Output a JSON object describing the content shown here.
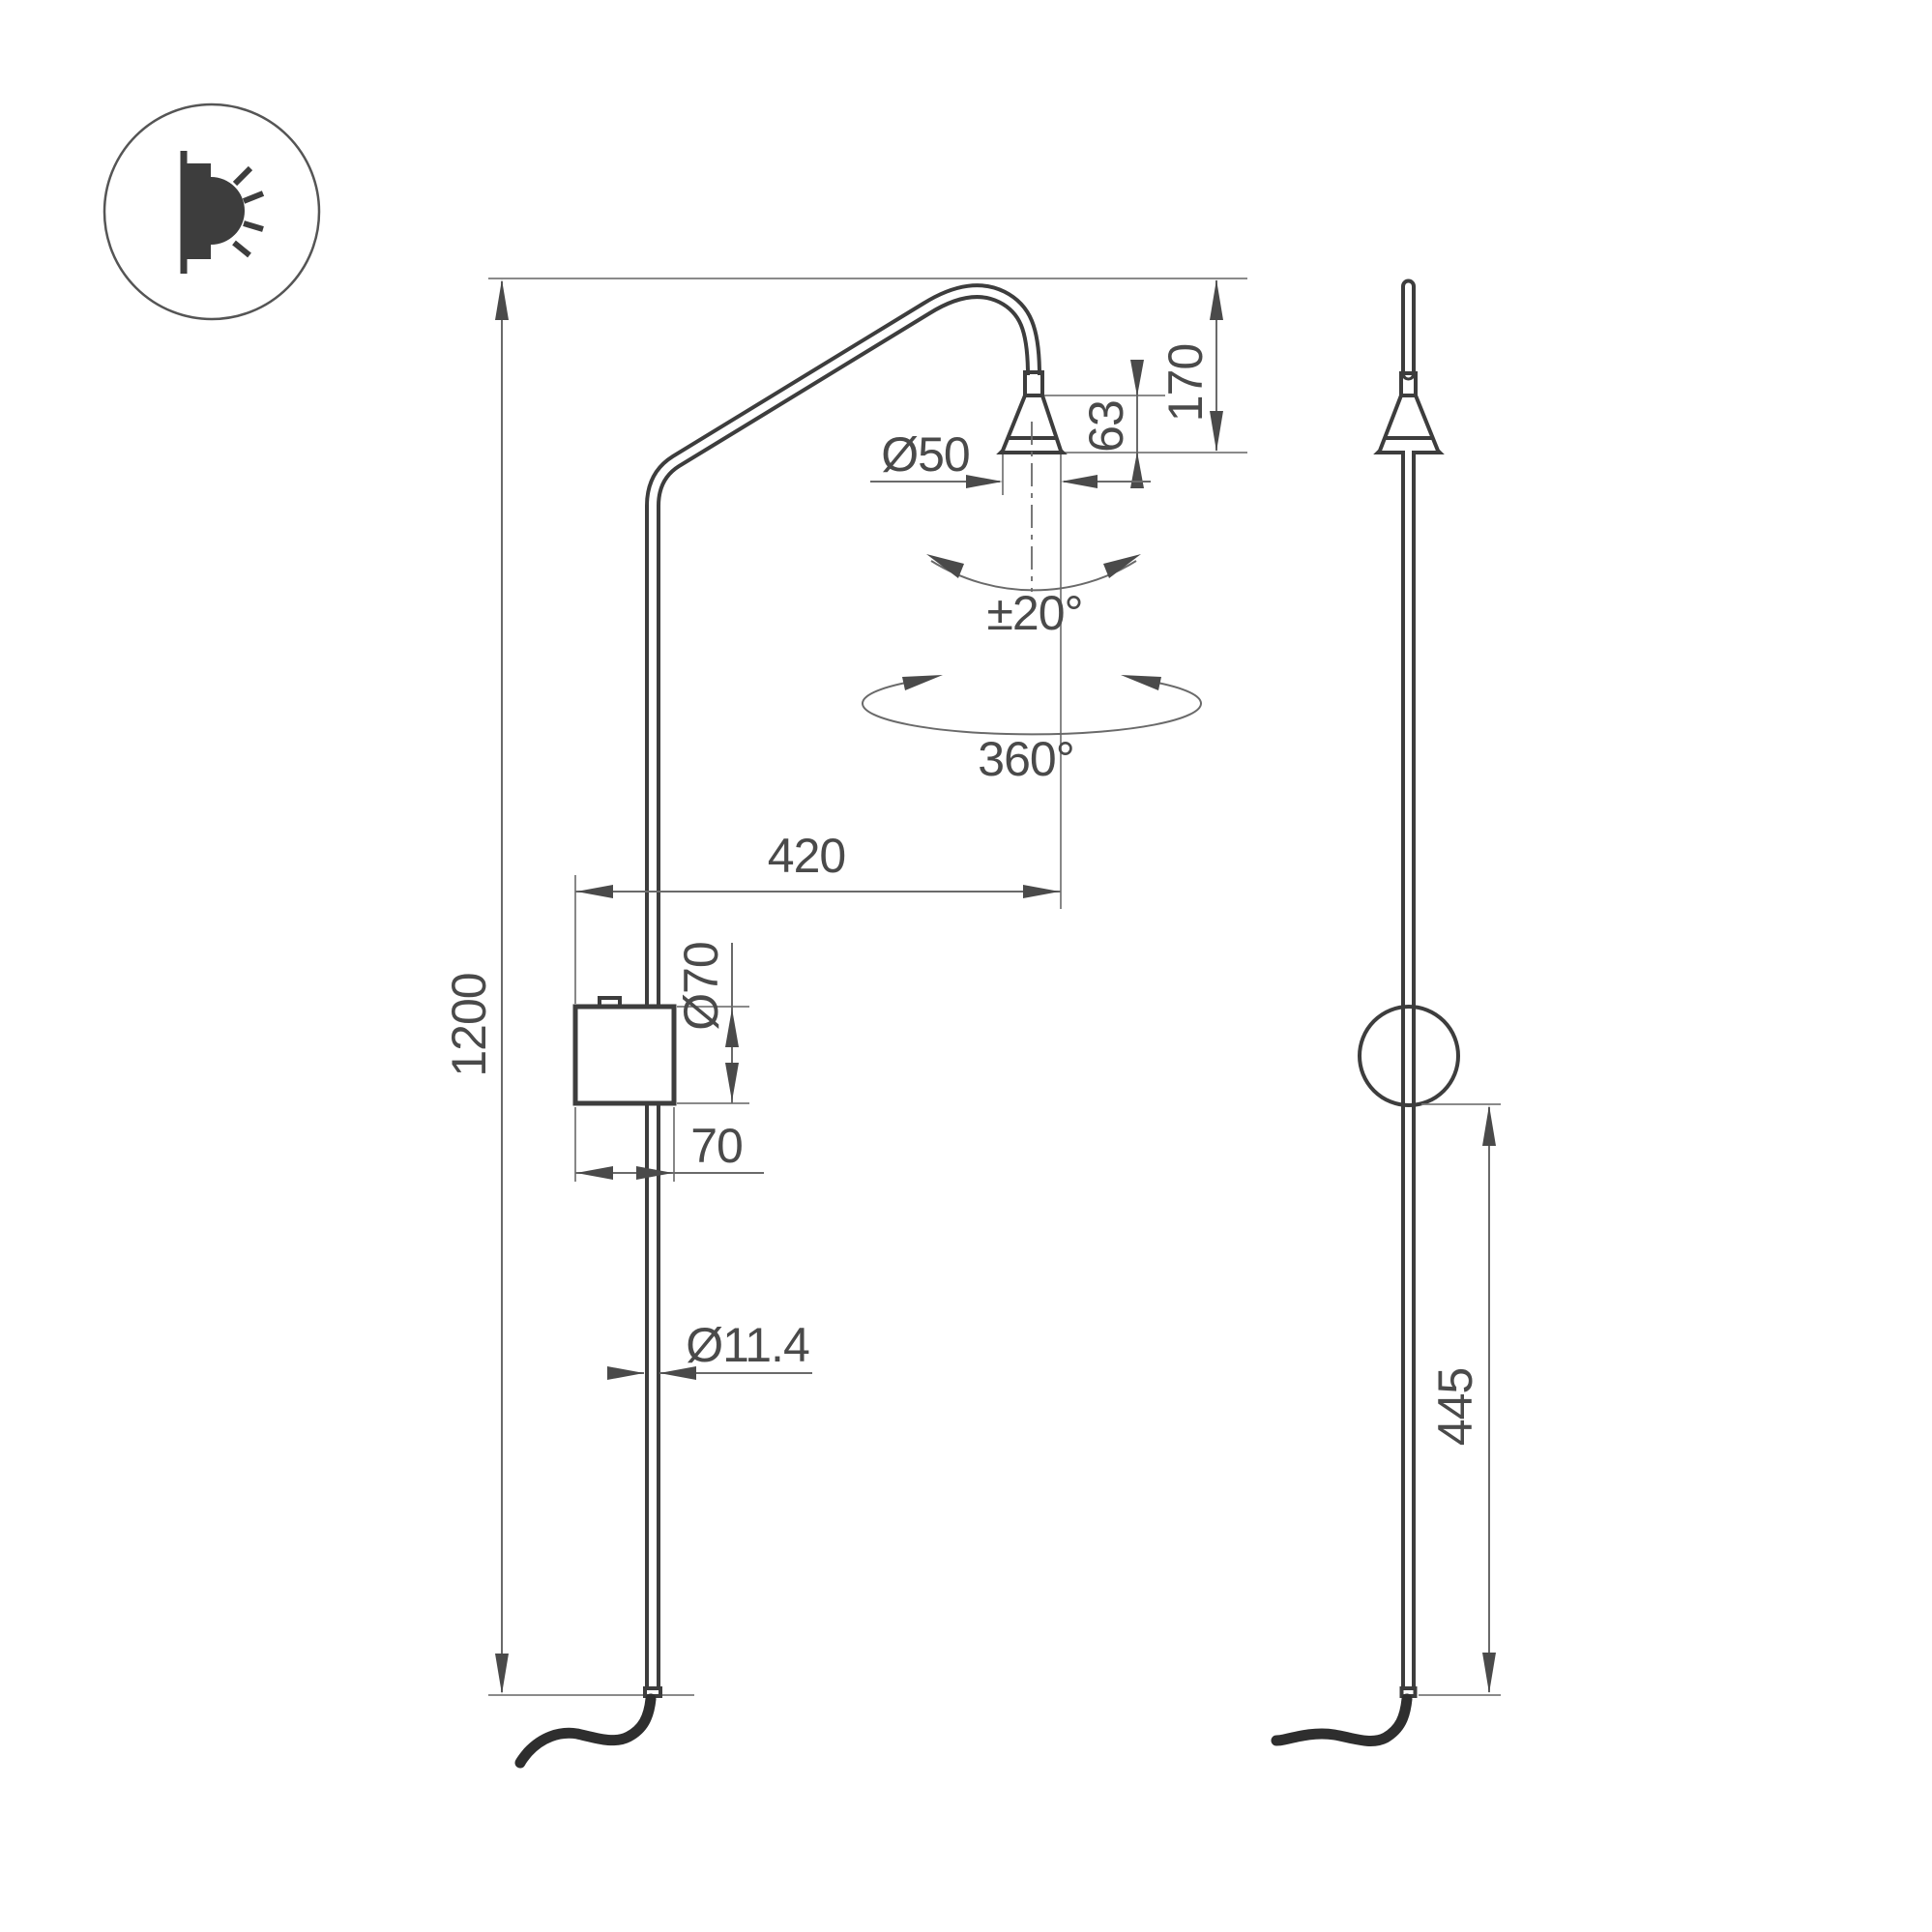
{
  "drawing": {
    "title": "wall-lamp-dimensional-drawing",
    "colors": {
      "object_line": "#3d3d3d",
      "dimension_line": "#6a6a6a",
      "text": "#4a4a4a",
      "background": "#ffffff"
    },
    "icon": {
      "name": "wall-light-icon"
    },
    "front_view": {
      "dims": {
        "total_height": "1200",
        "head_drop": "170",
        "cone_height": "63",
        "head_diameter": "Ø50",
        "tilt_angle": "±20°",
        "rotation_angle": "360°",
        "arm_reach": "420",
        "mount_diameter": "Ø70",
        "mount_depth": "70",
        "pole_diameter": "Ø11.4"
      }
    },
    "side_view": {
      "dims": {
        "lower_pole_length": "445"
      }
    }
  }
}
